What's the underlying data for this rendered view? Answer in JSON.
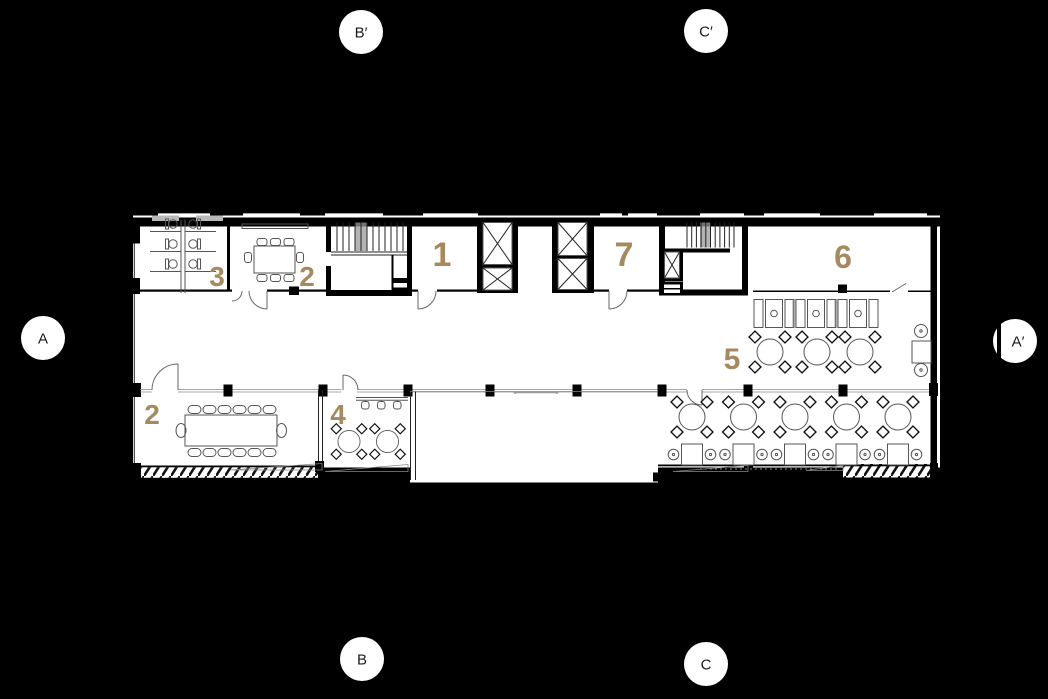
{
  "colors": {
    "background": "#000000",
    "plan_surface": "#ffffff",
    "wall_black": "#000000",
    "furniture_line": "#555555",
    "accent_gold": "#a5895f"
  },
  "section_markers": [
    {
      "id": "b-prime",
      "label": "B′"
    },
    {
      "id": "c-prime",
      "label": "C′"
    },
    {
      "id": "a",
      "label": "A"
    },
    {
      "id": "a-prime",
      "label": "A′"
    },
    {
      "id": "b",
      "label": "B"
    },
    {
      "id": "c",
      "label": "C"
    }
  ],
  "room_labels": [
    {
      "id": "room-3",
      "label": "3"
    },
    {
      "id": "room-2-upper",
      "label": "2"
    },
    {
      "id": "room-1",
      "label": "1"
    },
    {
      "id": "room-7",
      "label": "7"
    },
    {
      "id": "room-6",
      "label": "6"
    },
    {
      "id": "room-5",
      "label": "5"
    },
    {
      "id": "room-2-lower",
      "label": "2"
    },
    {
      "id": "room-4",
      "label": "4"
    }
  ]
}
